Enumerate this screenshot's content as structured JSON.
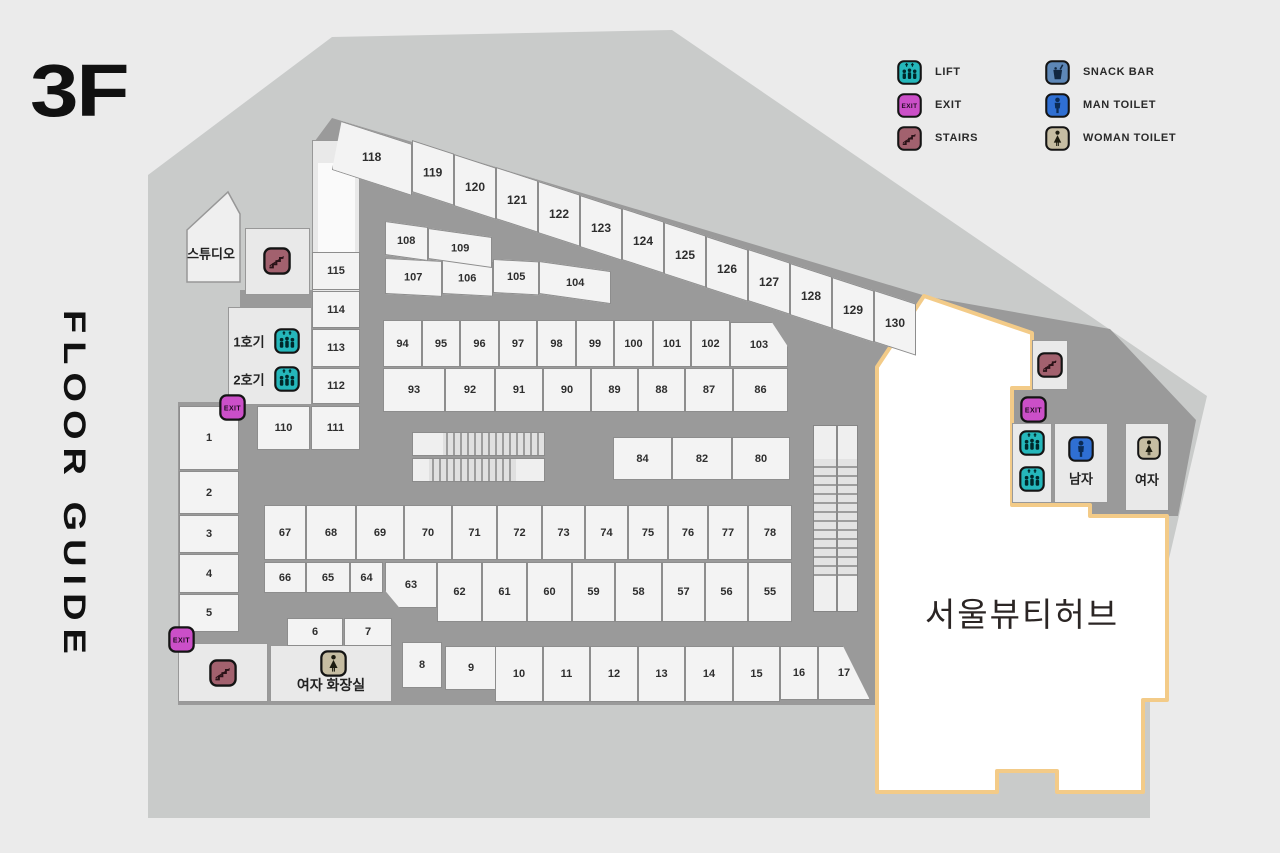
{
  "title": {
    "floor": "3F",
    "guide": "FLOOR GUIDE"
  },
  "colors": {
    "page_bg": "#ebebeb",
    "outer_band": "#c9cbca",
    "corridor": "#9a9a9a",
    "unit_fill": "#f3f3f3",
    "unit_border": "#8d8d8d",
    "hub_fill": "#ffffff",
    "hub_border": "#f3cb88",
    "lift": "#25b7bb",
    "exit": "#cb4fc8",
    "stairs": "#a2616e",
    "snack": "#5d87b7",
    "man": "#2f6fd3",
    "woman": "#c6bda2"
  },
  "legend": [
    {
      "id": "lift",
      "label": "LIFT",
      "col": 0,
      "row": 0
    },
    {
      "id": "exit",
      "label": "EXIT",
      "col": 0,
      "row": 1
    },
    {
      "id": "stairs",
      "label": "STAIRS",
      "col": 0,
      "row": 2
    },
    {
      "id": "snack",
      "label": "SNACK BAR",
      "col": 1,
      "row": 0
    },
    {
      "id": "man",
      "label": "MAN TOILET",
      "col": 1,
      "row": 1
    },
    {
      "id": "woman",
      "label": "WOMAN TOILET",
      "col": 1,
      "row": 2
    }
  ],
  "labels": {
    "studio": "스튜디오",
    "lift1": "1호기",
    "lift2": "2호기",
    "restroom_w": "여자 화장실",
    "man": "남자",
    "woman": "여자",
    "hub": "서울뷰티허브"
  },
  "map_labels": [
    {
      "key": "studio",
      "x": 211,
      "y": 253,
      "size": 13
    },
    {
      "key": "lift1",
      "x": 249,
      "y": 341,
      "size": 13
    },
    {
      "key": "lift2",
      "x": 249,
      "y": 379,
      "size": 13
    },
    {
      "key": "restroom_w",
      "x": 331,
      "y": 685,
      "size": 14
    },
    {
      "key": "man",
      "x": 1081,
      "y": 478,
      "size": 13
    },
    {
      "key": "woman",
      "x": 1147,
      "y": 479,
      "size": 13
    },
    {
      "key": "hub",
      "x": 1022,
      "y": 612,
      "size": 33,
      "id": "hub-label"
    }
  ],
  "map_icons": [
    {
      "t": "stairs",
      "x": 263,
      "y": 247,
      "s": 28
    },
    {
      "t": "lift",
      "x": 274,
      "y": 328,
      "s": 26
    },
    {
      "t": "lift",
      "x": 274,
      "y": 366,
      "s": 26
    },
    {
      "t": "exit",
      "x": 219,
      "y": 394,
      "s": 27
    },
    {
      "t": "exit",
      "x": 168,
      "y": 626,
      "s": 27
    },
    {
      "t": "stairs",
      "x": 209,
      "y": 659,
      "s": 28
    },
    {
      "t": "woman",
      "x": 320,
      "y": 650,
      "s": 27
    },
    {
      "t": "stairs",
      "x": 1037,
      "y": 352,
      "s": 26
    },
    {
      "t": "exit",
      "x": 1020,
      "y": 396,
      "s": 27
    },
    {
      "t": "lift",
      "x": 1019,
      "y": 430,
      "s": 26
    },
    {
      "t": "lift",
      "x": 1019,
      "y": 466,
      "s": 26
    },
    {
      "t": "man",
      "x": 1068,
      "y": 436,
      "s": 26
    },
    {
      "t": "woman",
      "x": 1137,
      "y": 436,
      "s": 24
    }
  ],
  "boxes": [
    {
      "name": "stairs-box-topleft",
      "x": 245,
      "y": 228,
      "w": 65,
      "h": 67
    },
    {
      "name": "shaft",
      "x": 312,
      "y": 140,
      "w": 48,
      "h": 155
    },
    {
      "name": "shaft-inner",
      "x": 318,
      "y": 163,
      "w": 37,
      "h": 92,
      "plain": true
    },
    {
      "name": "elevator-lobby",
      "x": 228,
      "y": 307,
      "w": 84,
      "h": 98
    },
    {
      "name": "bottomleft-box",
      "x": 178,
      "y": 643,
      "w": 90,
      "h": 59
    },
    {
      "name": "restroom-left-box",
      "x": 270,
      "y": 645,
      "w": 122,
      "h": 57
    },
    {
      "name": "stairs-box-right",
      "x": 1032,
      "y": 340,
      "w": 36,
      "h": 50
    },
    {
      "name": "lift-lobby-right",
      "x": 1012,
      "y": 423,
      "w": 40,
      "h": 80
    },
    {
      "name": "man-toilet-box",
      "x": 1054,
      "y": 423,
      "w": 54,
      "h": 80
    },
    {
      "name": "woman-toilet-box",
      "x": 1125,
      "y": 423,
      "w": 44,
      "h": 88
    }
  ],
  "units": [
    {
      "n": "1",
      "x": 179,
      "y": 406,
      "w": 60,
      "h": 64
    },
    {
      "n": "2",
      "x": 179,
      "y": 471,
      "w": 60,
      "h": 43
    },
    {
      "n": "3",
      "x": 179,
      "y": 515,
      "w": 60,
      "h": 38
    },
    {
      "n": "4",
      "x": 179,
      "y": 554,
      "w": 60,
      "h": 39
    },
    {
      "n": "5",
      "x": 179,
      "y": 594,
      "w": 60,
      "h": 38
    },
    {
      "n": "6",
      "x": 287,
      "y": 618,
      "w": 56,
      "h": 28
    },
    {
      "n": "7",
      "x": 344,
      "y": 618,
      "w": 48,
      "h": 28
    },
    {
      "n": "8",
      "x": 402,
      "y": 642,
      "w": 40,
      "h": 46
    },
    {
      "n": "9",
      "x": 445,
      "y": 646,
      "w": 52,
      "h": 44
    },
    {
      "n": "10",
      "x": 495,
      "y": 646,
      "w": 48,
      "h": 56
    },
    {
      "n": "11",
      "x": 543,
      "y": 646,
      "w": 47,
      "h": 56
    },
    {
      "n": "12",
      "x": 590,
      "y": 646,
      "w": 48,
      "h": 56
    },
    {
      "n": "13",
      "x": 638,
      "y": 646,
      "w": 47,
      "h": 56
    },
    {
      "n": "14",
      "x": 685,
      "y": 646,
      "w": 48,
      "h": 56
    },
    {
      "n": "15",
      "x": 733,
      "y": 646,
      "w": 47,
      "h": 56
    },
    {
      "n": "16",
      "x": 780,
      "y": 646,
      "w": 38,
      "h": 54
    },
    {
      "n": "17",
      "x": 818,
      "y": 646,
      "w": 52,
      "h": 54,
      "clip": "polygon(0 0,48% 0,100% 100%,0 100%)"
    },
    {
      "n": "55",
      "x": 748,
      "y": 562,
      "w": 44,
      "h": 60
    },
    {
      "n": "56",
      "x": 705,
      "y": 562,
      "w": 43,
      "h": 60
    },
    {
      "n": "57",
      "x": 662,
      "y": 562,
      "w": 43,
      "h": 60
    },
    {
      "n": "58",
      "x": 615,
      "y": 562,
      "w": 47,
      "h": 60
    },
    {
      "n": "59",
      "x": 572,
      "y": 562,
      "w": 43,
      "h": 60
    },
    {
      "n": "60",
      "x": 527,
      "y": 562,
      "w": 45,
      "h": 60
    },
    {
      "n": "61",
      "x": 482,
      "y": 562,
      "w": 45,
      "h": 60
    },
    {
      "n": "62",
      "x": 437,
      "y": 562,
      "w": 45,
      "h": 60
    },
    {
      "n": "63",
      "x": 385,
      "y": 562,
      "w": 52,
      "h": 46,
      "clip": "polygon(0 0,100% 0,100% 100%,28% 100%,0 62%)"
    },
    {
      "n": "64",
      "x": 350,
      "y": 562,
      "w": 33,
      "h": 31
    },
    {
      "n": "65",
      "x": 306,
      "y": 562,
      "w": 44,
      "h": 31
    },
    {
      "n": "66",
      "x": 264,
      "y": 562,
      "w": 42,
      "h": 31
    },
    {
      "n": "67",
      "x": 264,
      "y": 505,
      "w": 42,
      "h": 55
    },
    {
      "n": "68",
      "x": 306,
      "y": 505,
      "w": 50,
      "h": 55
    },
    {
      "n": "69",
      "x": 356,
      "y": 505,
      "w": 48,
      "h": 55
    },
    {
      "n": "70",
      "x": 404,
      "y": 505,
      "w": 48,
      "h": 55
    },
    {
      "n": "71",
      "x": 452,
      "y": 505,
      "w": 45,
      "h": 55
    },
    {
      "n": "72",
      "x": 497,
      "y": 505,
      "w": 45,
      "h": 55
    },
    {
      "n": "73",
      "x": 542,
      "y": 505,
      "w": 43,
      "h": 55
    },
    {
      "n": "74",
      "x": 585,
      "y": 505,
      "w": 43,
      "h": 55
    },
    {
      "n": "75",
      "x": 628,
      "y": 505,
      "w": 40,
      "h": 55
    },
    {
      "n": "76",
      "x": 668,
      "y": 505,
      "w": 40,
      "h": 55
    },
    {
      "n": "77",
      "x": 708,
      "y": 505,
      "w": 40,
      "h": 55
    },
    {
      "n": "78",
      "x": 748,
      "y": 505,
      "w": 44,
      "h": 55
    },
    {
      "n": "80",
      "x": 732,
      "y": 437,
      "w": 58,
      "h": 43
    },
    {
      "n": "82",
      "x": 672,
      "y": 437,
      "w": 60,
      "h": 43
    },
    {
      "n": "84",
      "x": 613,
      "y": 437,
      "w": 59,
      "h": 43
    },
    {
      "n": "86",
      "x": 733,
      "y": 368,
      "w": 55,
      "h": 44
    },
    {
      "n": "87",
      "x": 685,
      "y": 368,
      "w": 48,
      "h": 44
    },
    {
      "n": "88",
      "x": 638,
      "y": 368,
      "w": 47,
      "h": 44
    },
    {
      "n": "89",
      "x": 591,
      "y": 368,
      "w": 47,
      "h": 44
    },
    {
      "n": "90",
      "x": 543,
      "y": 368,
      "w": 48,
      "h": 44
    },
    {
      "n": "91",
      "x": 495,
      "y": 368,
      "w": 48,
      "h": 44
    },
    {
      "n": "92",
      "x": 445,
      "y": 368,
      "w": 50,
      "h": 44
    },
    {
      "n": "93",
      "x": 383,
      "y": 368,
      "w": 62,
      "h": 44
    },
    {
      "n": "94",
      "x": 383,
      "y": 320,
      "w": 39,
      "h": 47
    },
    {
      "n": "95",
      "x": 422,
      "y": 320,
      "w": 38,
      "h": 47
    },
    {
      "n": "96",
      "x": 460,
      "y": 320,
      "w": 39,
      "h": 47
    },
    {
      "n": "97",
      "x": 499,
      "y": 320,
      "w": 38,
      "h": 47
    },
    {
      "n": "98",
      "x": 537,
      "y": 320,
      "w": 39,
      "h": 47
    },
    {
      "n": "99",
      "x": 576,
      "y": 320,
      "w": 38,
      "h": 47
    },
    {
      "n": "100",
      "x": 614,
      "y": 320,
      "w": 39,
      "h": 47
    },
    {
      "n": "101",
      "x": 653,
      "y": 320,
      "w": 38,
      "h": 47
    },
    {
      "n": "102",
      "x": 691,
      "y": 320,
      "w": 39,
      "h": 47
    },
    {
      "n": "103",
      "x": 730,
      "y": 322,
      "w": 58,
      "h": 45,
      "clip": "polygon(0 0,72% 0,100% 55%,100% 100%,0 100%)"
    },
    {
      "n": "104",
      "x": 539,
      "y": 261,
      "w": 72,
      "h": 33,
      "skew": 8
    },
    {
      "n": "105",
      "x": 493,
      "y": 259,
      "w": 46,
      "h": 34,
      "skew": 3
    },
    {
      "n": "106",
      "x": 442,
      "y": 259,
      "w": 51,
      "h": 35,
      "skew": 3
    },
    {
      "n": "107",
      "x": 385,
      "y": 258,
      "w": 57,
      "h": 36,
      "skew": 3
    },
    {
      "n": "108",
      "x": 385,
      "y": 221,
      "w": 43,
      "h": 34,
      "skew": 8
    },
    {
      "n": "109",
      "x": 428,
      "y": 228,
      "w": 64,
      "h": 31,
      "skew": 8
    },
    {
      "n": "110",
      "x": 257,
      "y": 406,
      "w": 53,
      "h": 44
    },
    {
      "n": "111",
      "x": 311,
      "y": 406,
      "w": 49,
      "h": 44
    },
    {
      "n": "112",
      "x": 312,
      "y": 368,
      "w": 48,
      "h": 36
    },
    {
      "n": "113",
      "x": 312,
      "y": 329,
      "w": 48,
      "h": 38
    },
    {
      "n": "114",
      "x": 312,
      "y": 291,
      "w": 48,
      "h": 37
    },
    {
      "n": "115",
      "x": 312,
      "y": 252,
      "w": 48,
      "h": 38
    },
    {
      "n": "118",
      "x": 332,
      "y": 118,
      "w": 80,
      "h": 52,
      "skew": 18,
      "strip": true,
      "clip": "polygon(12% 0,100% 0,100% 100%,0 100%)"
    },
    {
      "n": "119",
      "x": 412,
      "y": 140,
      "w": 42,
      "h": 52,
      "skew": 18,
      "strip": true
    },
    {
      "n": "120",
      "x": 454,
      "y": 154,
      "w": 42,
      "h": 52,
      "skew": 18,
      "strip": true
    },
    {
      "n": "121",
      "x": 496,
      "y": 167,
      "w": 42,
      "h": 52,
      "skew": 18,
      "strip": true
    },
    {
      "n": "122",
      "x": 538,
      "y": 181,
      "w": 42,
      "h": 52,
      "skew": 18,
      "strip": true
    },
    {
      "n": "123",
      "x": 580,
      "y": 195,
      "w": 42,
      "h": 52,
      "skew": 18,
      "strip": true
    },
    {
      "n": "124",
      "x": 622,
      "y": 208,
      "w": 42,
      "h": 52,
      "skew": 18,
      "strip": true
    },
    {
      "n": "125",
      "x": 664,
      "y": 222,
      "w": 42,
      "h": 52,
      "skew": 18,
      "strip": true
    },
    {
      "n": "126",
      "x": 706,
      "y": 236,
      "w": 42,
      "h": 52,
      "skew": 18,
      "strip": true
    },
    {
      "n": "127",
      "x": 748,
      "y": 249,
      "w": 42,
      "h": 52,
      "skew": 18,
      "strip": true
    },
    {
      "n": "128",
      "x": 790,
      "y": 263,
      "w": 42,
      "h": 52,
      "skew": 18,
      "strip": true
    },
    {
      "n": "129",
      "x": 832,
      "y": 277,
      "w": 42,
      "h": 52,
      "skew": 18,
      "strip": true
    },
    {
      "n": "130",
      "x": 874,
      "y": 290,
      "w": 42,
      "h": 52,
      "skew": 18,
      "strip": true
    }
  ]
}
